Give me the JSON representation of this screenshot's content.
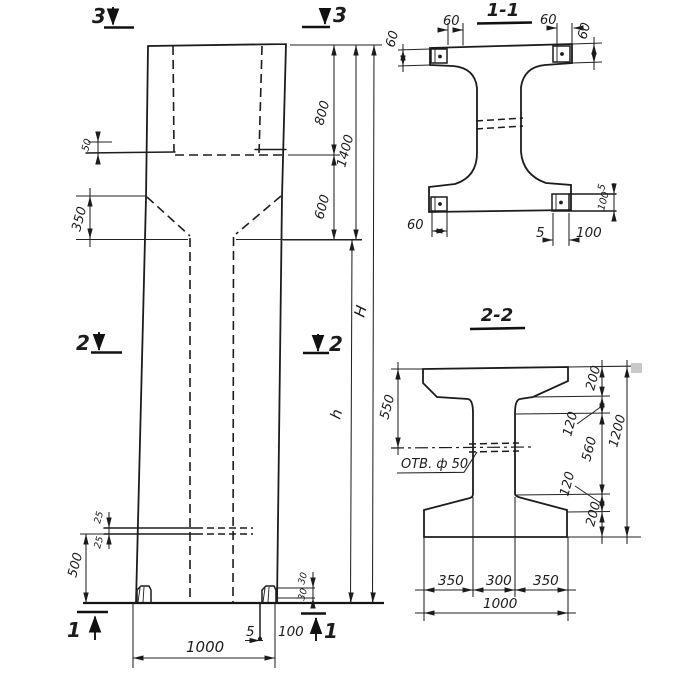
{
  "sheet": {
    "background": "#ffffff",
    "ink": "#1c1c1c",
    "artifact_gray": "#c9c9c9"
  },
  "elevation": {
    "marks": {
      "top_left": "3",
      "top_right": "3",
      "mid_left": "2",
      "mid_right": "2",
      "bottom_left": "1",
      "bottom_right": "1"
    },
    "dims": {
      "top": "800",
      "head_total": "1400",
      "neck": "600",
      "ledge": "50",
      "chamfer": "350",
      "total_height": "H",
      "shaft_height": "h",
      "base_offset": "500",
      "plate_upper": "25",
      "plate_lower": "25",
      "foot_upper": "30",
      "foot_lower": "30",
      "base_plate_thk": "5",
      "base_plate_h": "100",
      "base_width": "1000"
    }
  },
  "section_1_1": {
    "title": "1-1",
    "dims": {
      "top_left": "60",
      "left": "60",
      "top_right": "60",
      "right": "60",
      "bottom_left": "60",
      "bottom_thk": "5",
      "bottom_h": "100",
      "side_thk": "5",
      "side_h": "100"
    }
  },
  "section_2_2": {
    "title": "2-2",
    "hole_label": "ОТВ. ф 50",
    "dims": {
      "left": "550",
      "right_top": "200",
      "right_upper": "120",
      "right_mid": "560",
      "right_lower": "120",
      "right_bottom": "200",
      "right_total": "1200",
      "bottom_left": "350",
      "bottom_mid": "300",
      "bottom_right": "350",
      "bottom_total": "1000"
    }
  }
}
